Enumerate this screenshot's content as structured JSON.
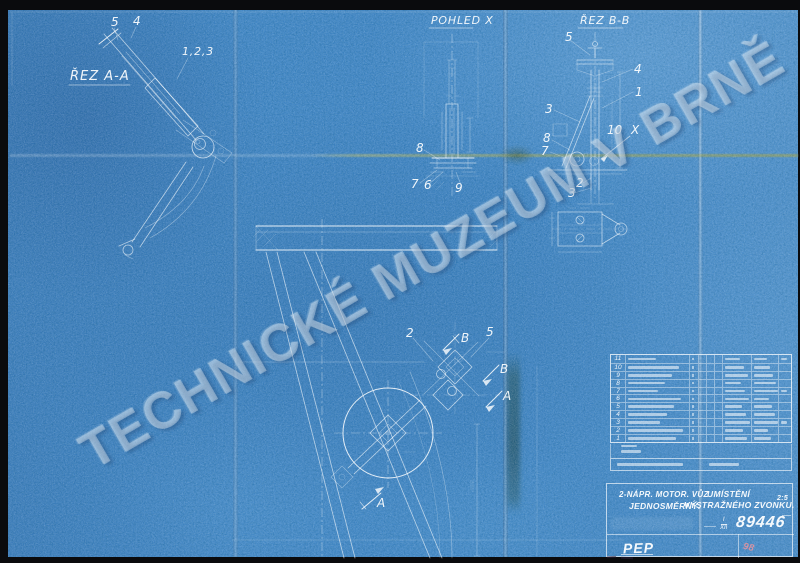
{
  "watermark": "TECHNICKÉ MUZEUM V BRNĚ",
  "views": {
    "rez_aa": {
      "label": "ŘEZ A-A",
      "callouts": {
        "c5": "5",
        "c4": "4",
        "c123": "1,2,3"
      }
    },
    "pohled_x": {
      "label": "POHLED X",
      "callouts": {
        "c8": "8",
        "c7": "7",
        "c6": "6",
        "c9": "9"
      }
    },
    "rez_bb": {
      "label": "ŘEZ B-B",
      "callouts": {
        "c5": "5",
        "c4": "4",
        "c1": "1",
        "c3": "3",
        "c8": "8",
        "c7": "7",
        "c10": "10",
        "cx": "X",
        "c2": "2",
        "c3b": "3"
      }
    },
    "main": {
      "callouts": {
        "c2": "2",
        "c5": "5",
        "b1": "B",
        "b2": "B",
        "a1": "A",
        "a2": "A"
      }
    }
  },
  "parts_table": {
    "row_numbers": [
      "11",
      "10",
      "9",
      "8",
      "7",
      "6",
      "5",
      "4",
      "3",
      "2",
      "1"
    ]
  },
  "title_block": {
    "vehicle_line1": "2-NÁPR. MOTOR. VŮZ",
    "vehicle_line2": "JEDNOSMĚRNÝ.",
    "title_line1": "UMÍSTĚNÍ",
    "title_line2": "VÝSTRAŽNÉHO ZVONKU.",
    "scale": "2:5",
    "number_numerator": "I",
    "number_denominator": "XII",
    "drawing_number": "89446",
    "initials": "PEP",
    "corner_note": "98"
  }
}
